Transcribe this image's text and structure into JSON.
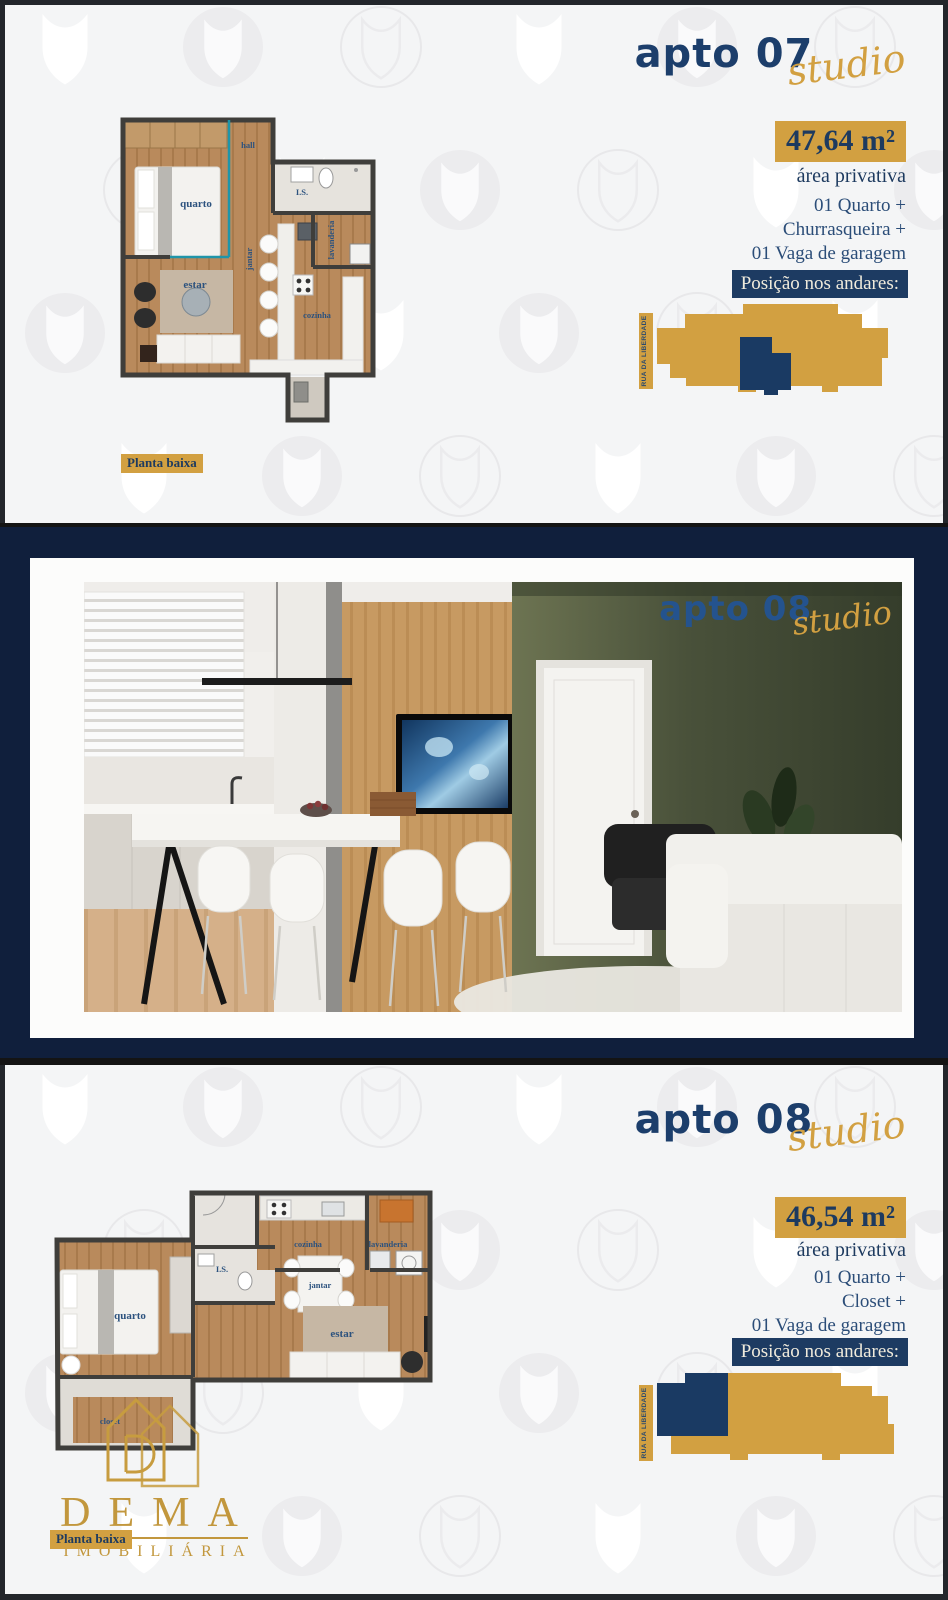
{
  "apto07": {
    "title": "apto 07",
    "script": "studio",
    "area": "47,64 m²",
    "area_caption": "área privativa",
    "features": [
      "01 Quarto +",
      "Churrasqueira +",
      "01 Vaga de garagem"
    ],
    "position_label": "Posição nos andares:",
    "street": "RUA DA LIBERDADE",
    "plan_caption": "Planta baixa",
    "rooms": {
      "quarto": "quarto",
      "hall": "hall",
      "is": "I.S.",
      "lavanderia": "lavanderia",
      "jantar": "jantar",
      "estar": "estar",
      "cozinha": "cozinha"
    }
  },
  "photo": {
    "title": "apto 08",
    "script": "studio"
  },
  "apto08": {
    "title": "apto 08",
    "script": "studio",
    "area": "46,54 m²",
    "area_caption": "área privativa",
    "features": [
      "01 Quarto +",
      "Closet +",
      "01 Vaga de garagem"
    ],
    "position_label": "Posição nos andares:",
    "street": "RUA DA LIBERDADE",
    "plan_caption": "Planta baixa",
    "rooms": {
      "quarto": "quarto",
      "closet": "closet",
      "is": "I.S.",
      "cozinha": "cozinha",
      "lavanderia": "lavanderia",
      "jantar": "jantar",
      "estar": "estar"
    }
  },
  "brand": {
    "name": "DEMA",
    "tagline": "IMOBILIÁRIA"
  },
  "icons": {
    "watermark": "dema-shield-watermark",
    "logo": "dema-house-logo"
  },
  "colors": {
    "navy": "#1c3e6b",
    "gold": "#d2a041",
    "band": "#101f3c",
    "bg": "#f4f5f6"
  }
}
